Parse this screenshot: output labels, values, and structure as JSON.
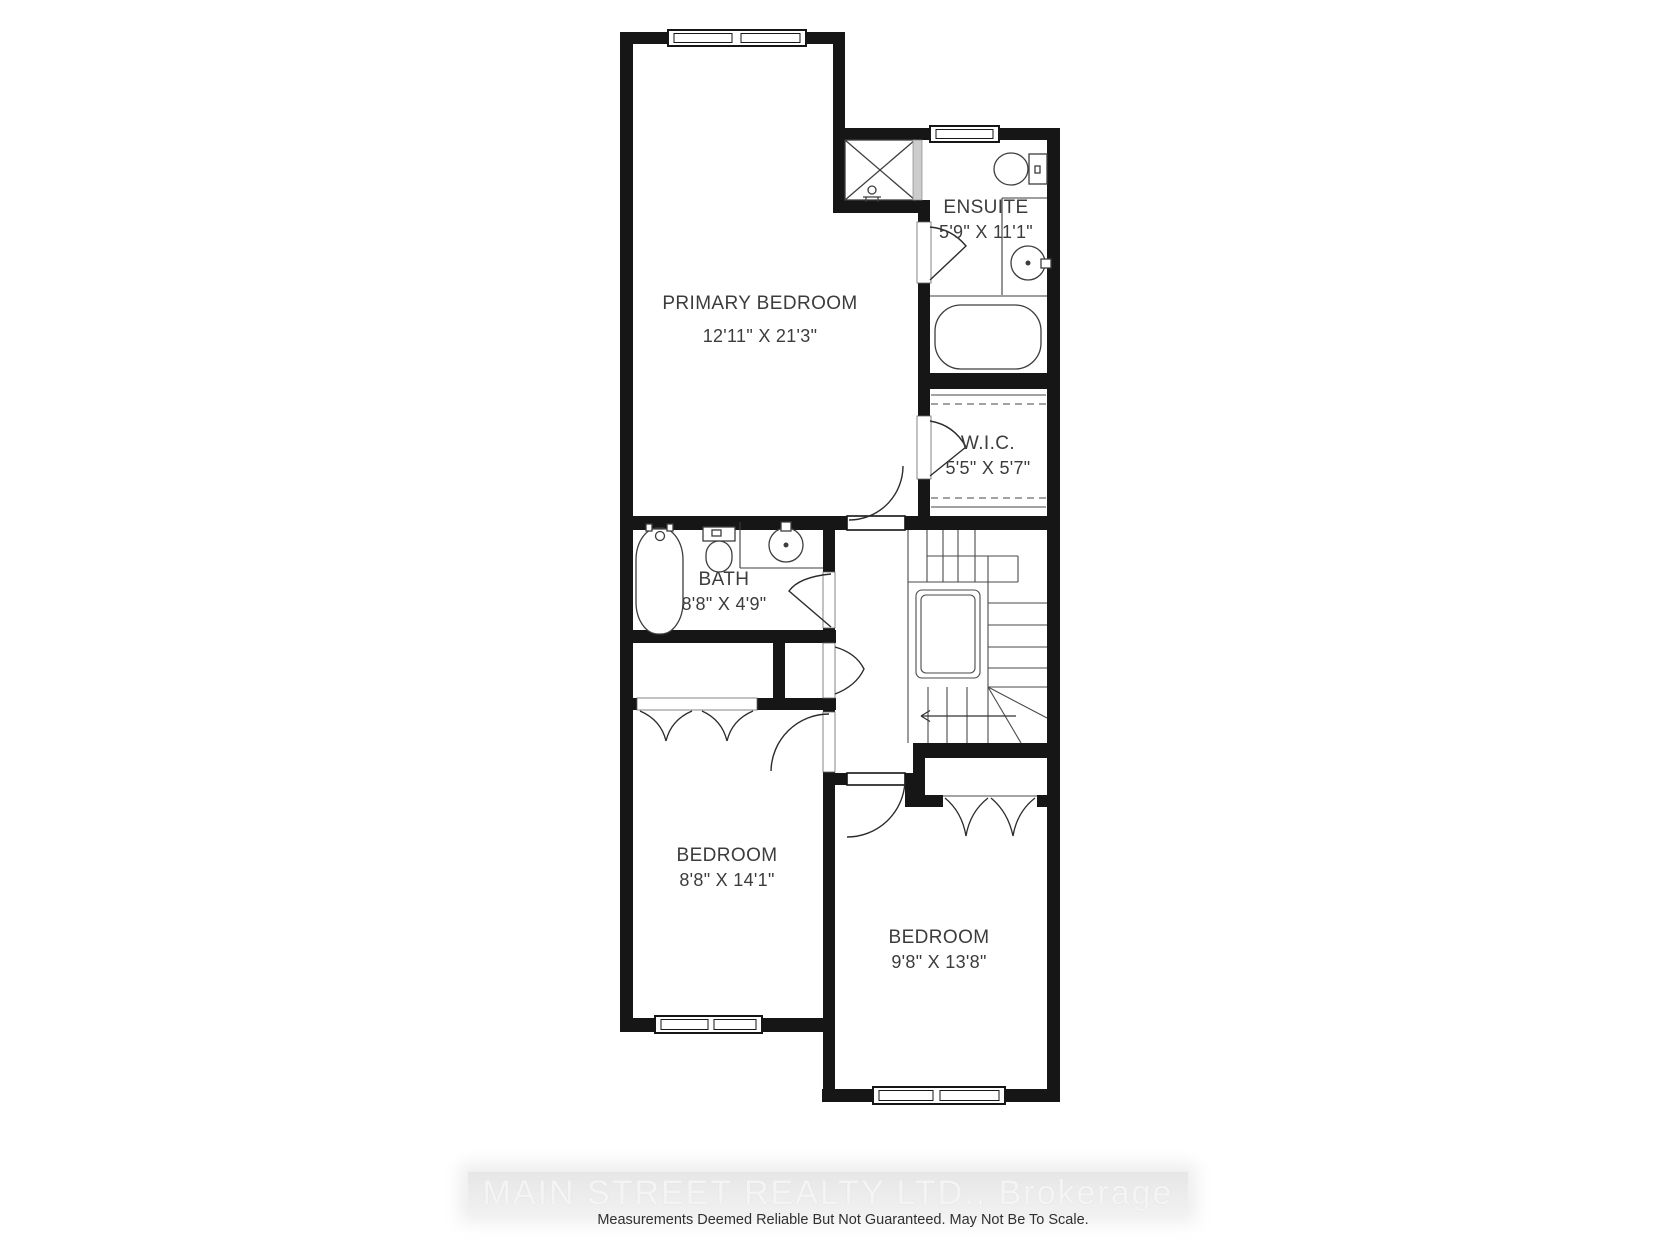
{
  "floorplan": {
    "title": "Second Floor Plan",
    "rooms": [
      {
        "id": "primary-bedroom",
        "name": "PRIMARY BEDROOM",
        "dimensions": "12'11\" X 21'3\""
      },
      {
        "id": "ensuite",
        "name": "ENSUITE",
        "dimensions": "5'9\" X 11'1\""
      },
      {
        "id": "wic",
        "name": "W.I.C.",
        "dimensions": "5'5\" X 5'7\""
      },
      {
        "id": "bath",
        "name": "BATH",
        "dimensions": "8'8\" X 4'9\""
      },
      {
        "id": "bedroom-left",
        "name": "BEDROOM",
        "dimensions": "8'8\" X 14'1\""
      },
      {
        "id": "bedroom-right",
        "name": "BEDROOM",
        "dimensions": "9'8\" X 13'8\""
      }
    ],
    "fixture_icons": [
      "shower-icon",
      "toilet-icon",
      "sink-icon",
      "bathtub-icon",
      "stairs-icon",
      "closet-rod-icon",
      "door-swing-icon",
      "window-icon"
    ]
  },
  "watermark": {
    "text": "MAIN STREET REALTY LTD., Brokerage"
  },
  "disclaimer": {
    "text": "Measurements Deemed Reliable But Not Guaranteed. May Not Be To Scale."
  },
  "colors": {
    "wall": "#161616",
    "fixture_line": "#3d3d3d",
    "label_text": "#3c3c3c",
    "watermark_text": "#f4f4f4",
    "watermark_band": "#e5e5e5",
    "disclaimer_text": "#303030"
  }
}
